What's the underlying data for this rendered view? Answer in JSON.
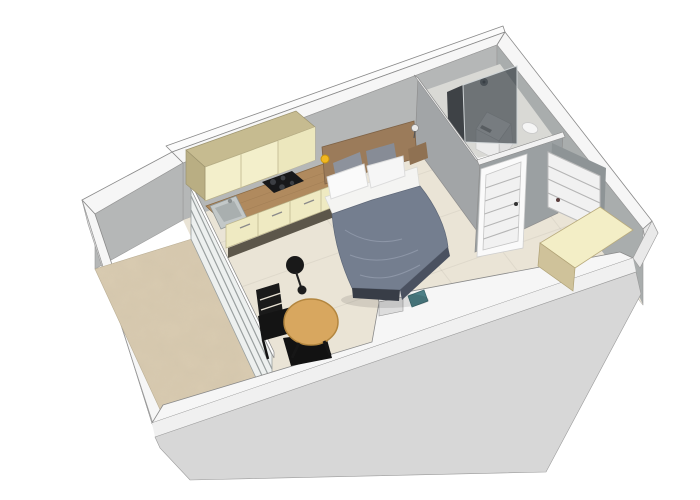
{
  "scene": {
    "type": "3d-floorplan-render",
    "background": "#ffffff"
  },
  "objects": [
    "kitchen-cabinets",
    "kitchen-counter",
    "cooktop",
    "sink",
    "double-bed",
    "headboard-panel",
    "wall-lamp-yellow",
    "wall-sconce",
    "shower-glass",
    "shower-head",
    "washing-machine",
    "toilet",
    "bathroom-door",
    "entry-door",
    "entry-cabinet",
    "round-table",
    "pendant-lamp",
    "chair",
    "chair",
    "balcony",
    "glazed-partition",
    "teal-bin",
    "stub-wall"
  ],
  "colors": {
    "bg": "#ffffff",
    "wall_top": "#f6f6f6",
    "wall_top_bright": "#fbfbfb",
    "wall_outer": "#d7d7d7",
    "wall_outer_hi": "#f0f0f0",
    "wall_outer_side": "#e3e3e3",
    "wall_corner": "#e9e9e9",
    "wall_inner_nw": "#b5b7b7",
    "wall_inner_ne": "#a9adad",
    "wall_bath_west": "#a2a5a7",
    "wall_bath_south": "#9ba0a2",
    "doorway_shadow": "#8e9496",
    "floor_main": "#eae4d6",
    "floor_balcony": "#d9cbb1",
    "floor_bath": "#d9d9d5",
    "tile_line": "rgba(0,0,0,0.05)",
    "glazing_face": "#edf0ef",
    "glazing_line": "#9aa0a0",
    "glass_dark": "rgba(55,62,68,0.66)",
    "glass_side": "rgba(28,33,38,0.82)",
    "cabinet_front": "#f3efcb",
    "cabinet_front_shade": "#ece7bd",
    "cabinet_top": "#c6bb90",
    "cabinet_side": "#b9ae83",
    "cabinet_seam": "#c9c29a",
    "counter_wood": "#b08a5e",
    "counter_grain": "#9a7850",
    "cooktop": "#17181a",
    "burner": "#3c3f44",
    "sink": "#c3c8c8",
    "sink_basin": "#a9afaf",
    "kick_dark": "#5c564a",
    "headboard": "#9b7b5a",
    "headboard_ledge": "#8f7152",
    "lamp_yellow": "#f2b820",
    "sconce": "#e9e9e9",
    "sheet": "#f4f4f2",
    "pillow_white": "#fafafa",
    "pillow_white2": "#f6f6f6",
    "pillow_gray": "#8d929c",
    "pillow_gray2": "#878c96",
    "duvet": "#747e8f",
    "duvet_crease": "#98a1b2",
    "duvet_side": "#4a5160",
    "bed_foot_dark": "#383d47",
    "shadow": "rgba(0,0,0,0.10)",
    "table_wood": "#d8a75f",
    "table_rim": "#b3863f",
    "chair_black": "#1a1a1a",
    "chair_dark2": "#121212",
    "pendant_black": "#191919",
    "door_white": "#f1f1f1",
    "door_frame": "#fafafa",
    "door_rail": "#b5b5b5",
    "door_handle": "#5a3d3d",
    "appliance_white": "#f4f4f4",
    "appliance_front": "#ececec",
    "appliance_side": "#e0e0e0",
    "appliance_slot": "#9a9a9a",
    "toilet_white": "#f5f5f5",
    "shower_metal": "#71757a",
    "entry_cab_top": "#f3eec6",
    "entry_cab_side": "#cfc29a",
    "teal": "#4d7f86",
    "edge": "#8a8a8a"
  }
}
